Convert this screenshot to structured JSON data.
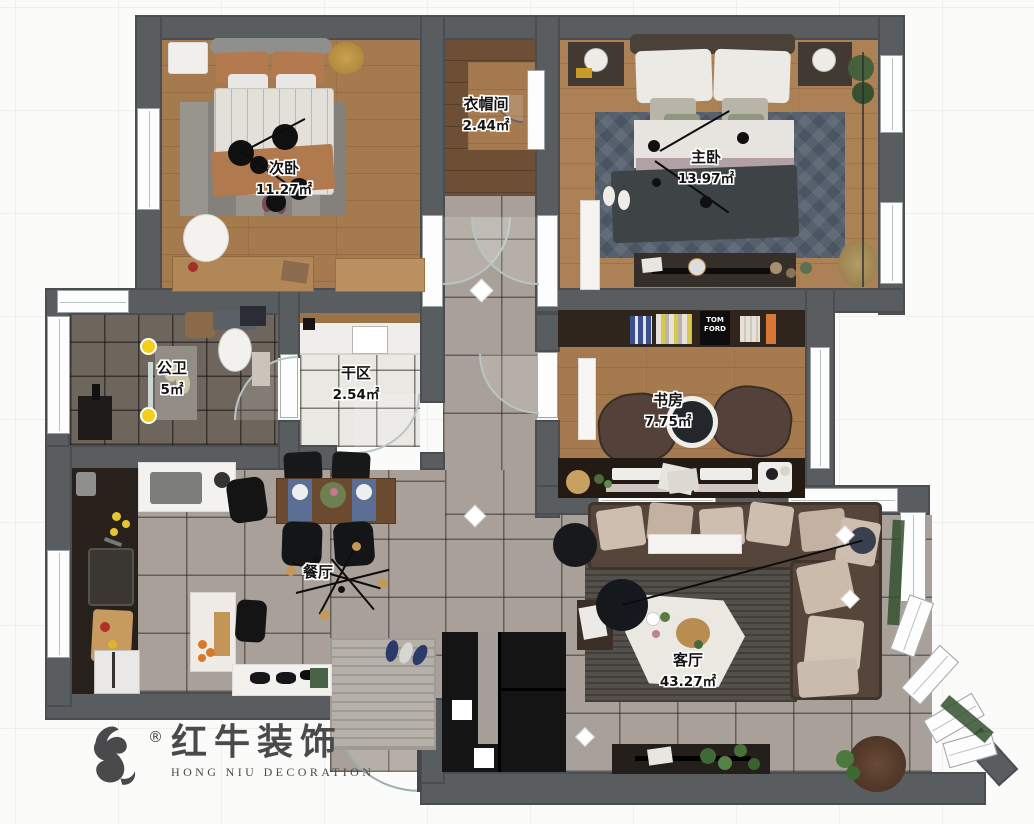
{
  "rooms": {
    "ciwo": {
      "name": "次卧",
      "area": "11.27㎡"
    },
    "yimaojian": {
      "name": "衣帽间",
      "area": "2.44㎡"
    },
    "zhuwo": {
      "name": "主卧",
      "area": "13.97㎡"
    },
    "gongwei": {
      "name": "公卫",
      "area": "5㎡"
    },
    "ganqu": {
      "name": "干区",
      "area": "2.54㎡"
    },
    "shufang": {
      "name": "书房",
      "area": "7.75㎡"
    },
    "canting": {
      "name": "餐厅",
      "area": ""
    },
    "keting": {
      "name": "客厅",
      "area": "43.27㎡"
    }
  },
  "logo": {
    "cn": "红牛装饰",
    "en": "HONG NIU DECORATION",
    "registered": "®"
  },
  "labels": {
    "bookshelf_brand": "TOM FORD"
  },
  "colors": {
    "wall": "#595d60",
    "wood": "#a67a4f",
    "tile": "#a9a199",
    "marble": "#eae8e3",
    "dark_tile": "#6e655d",
    "accent_yellow": "#f2cf1d",
    "sofa": "#55453b",
    "logo": "#4a4a4c"
  }
}
